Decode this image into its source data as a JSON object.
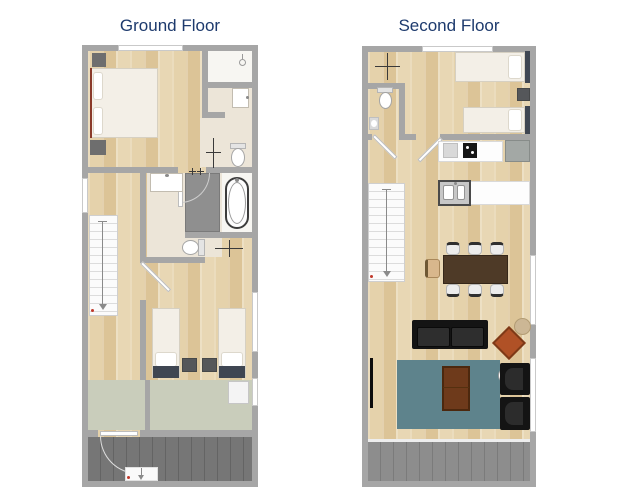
{
  "floors": [
    {
      "id": "ground-floor",
      "title": "Ground Floor",
      "rooms": [
        "master-bedroom",
        "shower-room",
        "bathroom",
        "family-bathroom",
        "hallway",
        "stairs",
        "twin-bedroom",
        "boot-room",
        "deck"
      ]
    },
    {
      "id": "second-floor",
      "title": "Second Floor",
      "rooms": [
        "twin-bedroom",
        "wc",
        "hallway",
        "kitchen",
        "dining-area",
        "living-room",
        "stairs",
        "balcony"
      ]
    }
  ],
  "colors": {
    "title": "#1d3a6d",
    "wall": "#a6a6a6",
    "wood": "#e1cba1",
    "tile": "#ece5d8",
    "shower": "#8f8f8f",
    "deck": "#767676",
    "balcony": "#8d8d8d",
    "boot": "#c9cdbb",
    "rug": "#5e838c",
    "sofa": "#141414",
    "armchair": "#b05126",
    "dtable": "#4e3a27",
    "ctable": "#6e3a1b",
    "linen": "#f3efe7",
    "hb": "#3f4652"
  }
}
